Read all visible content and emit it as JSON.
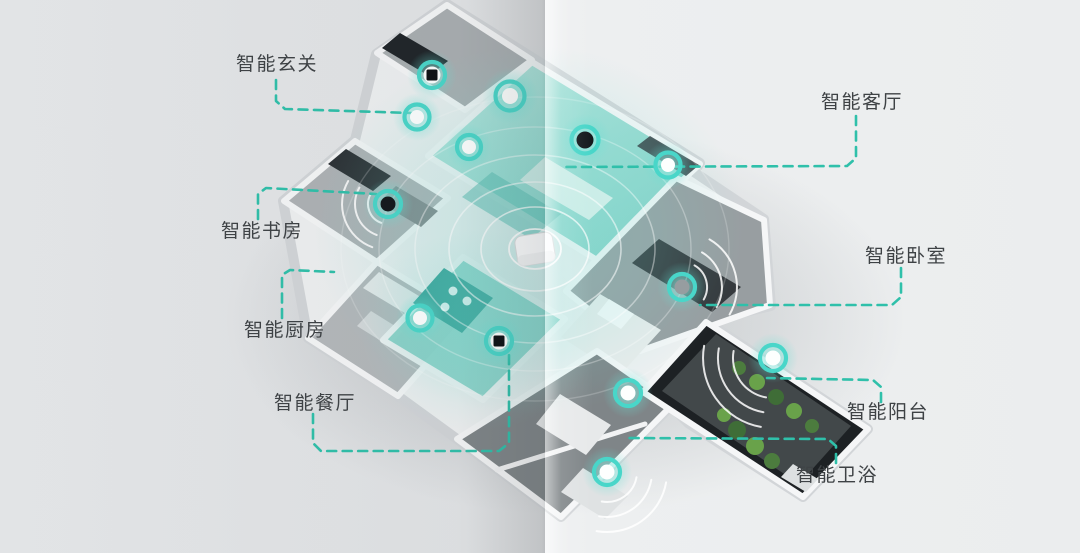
{
  "page": {
    "background_left": "#e4e6e8",
    "background_right": "#edeff0",
    "style": "isometric smart-home floor-plan infographic with center page fold"
  },
  "diagram": {
    "accent_color": "#2fc0aa",
    "device_ring_color": "#49d6c9",
    "label_color": "#3e4245",
    "labels": [
      {
        "id": "entry",
        "text": "智能玄关"
      },
      {
        "id": "living",
        "text": "智能客厅"
      },
      {
        "id": "study",
        "text": "智能书房"
      },
      {
        "id": "kitchen",
        "text": "智能厨房"
      },
      {
        "id": "dining",
        "text": "智能餐厅"
      },
      {
        "id": "bedroom",
        "text": "智能卧室"
      },
      {
        "id": "balcony",
        "text": "智能阳台"
      },
      {
        "id": "bathroom",
        "text": "智能卫浴"
      }
    ],
    "hub": {
      "icon": "gateway-hub-icon",
      "description": "white smart-home gateway with radiating ripple rings"
    },
    "devices": [
      {
        "room": "entry",
        "icon": "door-lock-sensor-icon",
        "core": "dark-square"
      },
      {
        "room": "entry",
        "icon": "wall-switch-sensor-icon",
        "core": "bright"
      },
      {
        "room": "hallway",
        "icon": "ceiling-sensor-icon",
        "core": "bright"
      },
      {
        "room": "hallway",
        "icon": "motion-sensor-icon",
        "core": "bright"
      },
      {
        "room": "living",
        "icon": "smart-speaker-icon",
        "core": "dark"
      },
      {
        "room": "living",
        "icon": "wall-ac-sensor-icon",
        "core": "bright"
      },
      {
        "room": "study",
        "icon": "study-sensor-icon",
        "core": "dark"
      },
      {
        "room": "kitchen",
        "icon": "kitchen-sensor-icon",
        "core": "bright"
      },
      {
        "room": "dining",
        "icon": "smart-panel-icon",
        "core": "dark-square"
      },
      {
        "room": "bedroom",
        "icon": "bedroom-sensor-icon",
        "core": "gray"
      },
      {
        "room": "bathroom",
        "icon": "washer-sensor-icon",
        "core": "bright"
      },
      {
        "room": "bathroom",
        "icon": "bath-sensor-icon",
        "core": "bright"
      },
      {
        "room": "balcony",
        "icon": "balcony-sensor-icon",
        "core": "bright"
      }
    ]
  }
}
